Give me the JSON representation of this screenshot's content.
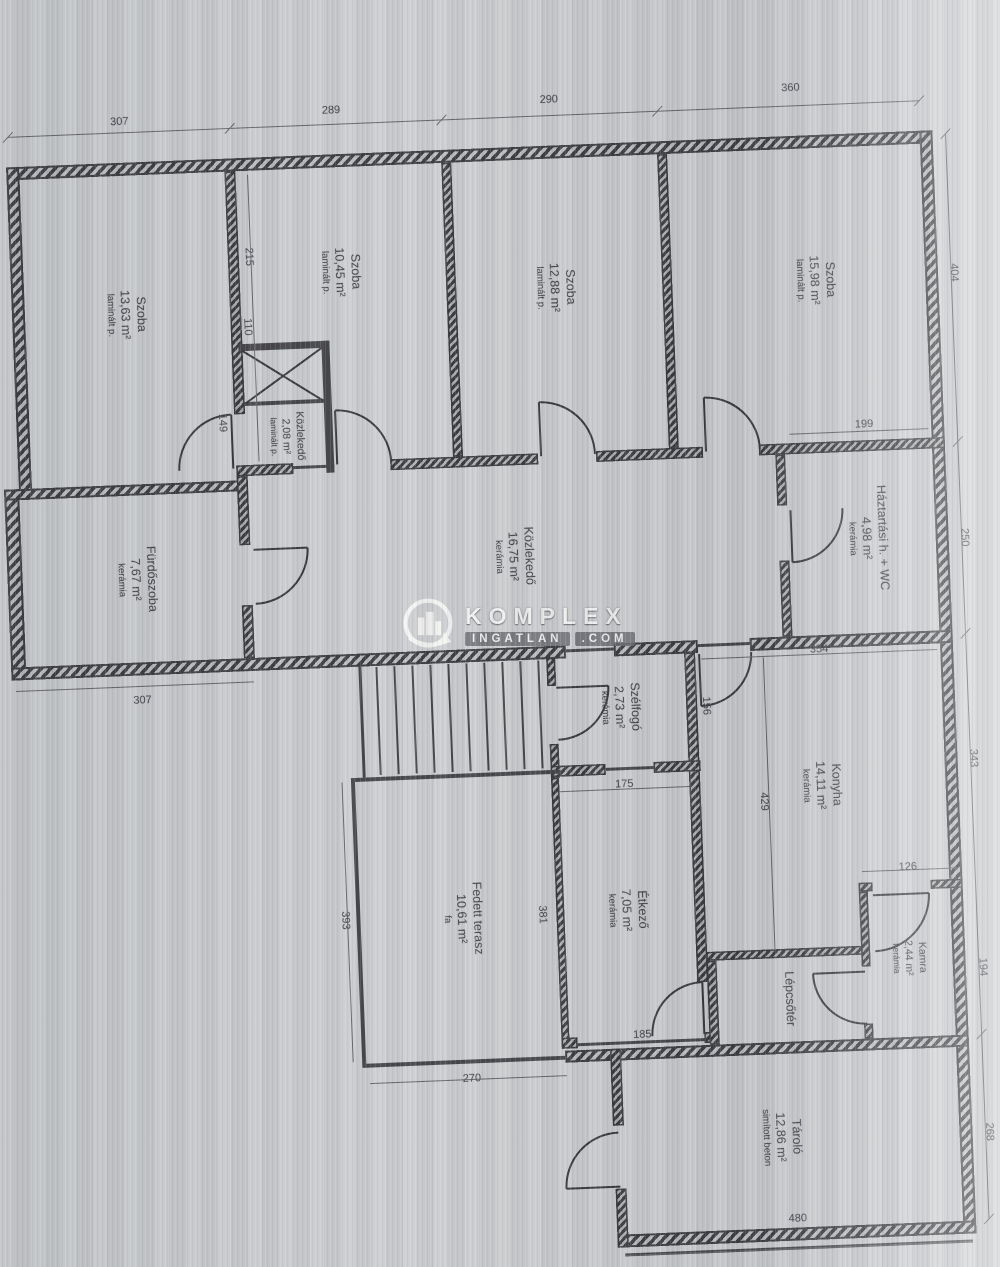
{
  "watermark": {
    "line1": "KOMPLEX",
    "line2a": "INGATLAN",
    "line2b": ".COM"
  },
  "rooms": [
    {
      "name": "Szoba",
      "area": "13,63 m²",
      "floor": "laminált p."
    },
    {
      "name": "Szoba",
      "area": "10,45 m²",
      "floor": "laminált p."
    },
    {
      "name": "Szoba",
      "area": "12,88 m²",
      "floor": "laminált p."
    },
    {
      "name": "Szoba",
      "area": "15,98 m²",
      "floor": "laminált p."
    },
    {
      "name": "Közlekedő",
      "area": "2,08 m²",
      "floor": "laminált p."
    },
    {
      "name": "Közlekedő",
      "area": "16,75 m²",
      "floor": "kerámia"
    },
    {
      "name": "Fürdőszoba",
      "area": "7,67 m²",
      "floor": "kerámia"
    },
    {
      "name": "Háztartási h. + WC",
      "area": "4,98 m²",
      "floor": "kerámia"
    },
    {
      "name": "Szélfogó",
      "area": "2,73 m²",
      "floor": "kerámia"
    },
    {
      "name": "Konyha",
      "area": "14,11 m²",
      "floor": "kerámia"
    },
    {
      "name": "Étkező",
      "area": "7,05 m²",
      "floor": "kerámia"
    },
    {
      "name": "Fedett terasz",
      "area": "10,61 m²",
      "floor": "fa"
    },
    {
      "name": "Kamra",
      "area": "2,44 m²",
      "floor": "kerámia"
    },
    {
      "name": "Lépcsőtér",
      "area": "",
      "floor": ""
    },
    {
      "name": "Tároló",
      "area": "12,86 m²",
      "floor": "simított beton"
    }
  ],
  "dims": {
    "szoba1_w": "307",
    "szoba2_w": "289",
    "szoba3_w": "290",
    "szoba4_w": "360",
    "wall_upper": "215",
    "shaft_w": "110",
    "door1": "149",
    "szoba4_h": "404",
    "haztartasi_w": "199",
    "haztartasi_h": "250",
    "furdo_w": "307",
    "konyha_top": "354",
    "szelfogo_side": "156",
    "szelfogo_w": "175",
    "konyha_h": "429",
    "konyha_side": "343",
    "etkezo_h": "381",
    "terasz_side": "393",
    "kamra_w": "126",
    "kamra_side": "194",
    "etkezo_bottom": "185",
    "terasz_w": "270",
    "tarolo_w": "480",
    "tarolo_side": "268"
  }
}
